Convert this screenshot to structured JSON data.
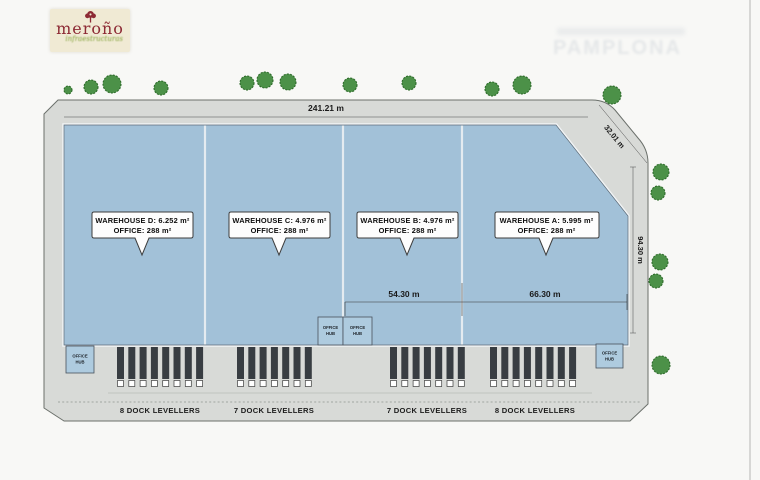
{
  "logo": {
    "name": "meroño",
    "tagline": "infraestructuras"
  },
  "watermark": {
    "title": "PAMPLONA"
  },
  "plan": {
    "dim_top": "241.21 m",
    "dim_chamfer": "32.01 m",
    "dim_right": "94.30 m",
    "dim_warehouse_b": "54.30 m",
    "dim_warehouse_a": "66.30 m",
    "office_hub": {
      "line1": "OFFICE",
      "line2": "HUB"
    },
    "warehouses": [
      {
        "id": "D",
        "label": "WAREHOUSE D: 6.252 m²",
        "office": "OFFICE: 288 m²",
        "dock_levellers": 8,
        "dock_label": "8 DOCK LEVELLERS"
      },
      {
        "id": "C",
        "label": "WAREHOUSE C: 4.976 m²",
        "office": "OFFICE: 288 m²",
        "dock_levellers": 7,
        "dock_label": "7 DOCK LEVELLERS"
      },
      {
        "id": "B",
        "label": "WAREHOUSE B: 4.976 m²",
        "office": "OFFICE: 288 m²",
        "dock_levellers": 7,
        "dock_label": "7 DOCK LEVELLERS"
      },
      {
        "id": "A",
        "label": "WAREHOUSE A: 5.995 m²",
        "office": "OFFICE: 288 m²",
        "dock_levellers": 8,
        "dock_label": "8 DOCK LEVELLERS"
      }
    ]
  },
  "colors": {
    "road_fill": "#d8dad7",
    "warehouse_fill": "#a2c1d8",
    "office_hub_fill": "#aecbdf",
    "tree_green": "#4c9148",
    "dock_bar": "#383d42",
    "logo_red": "#8d2b35"
  }
}
